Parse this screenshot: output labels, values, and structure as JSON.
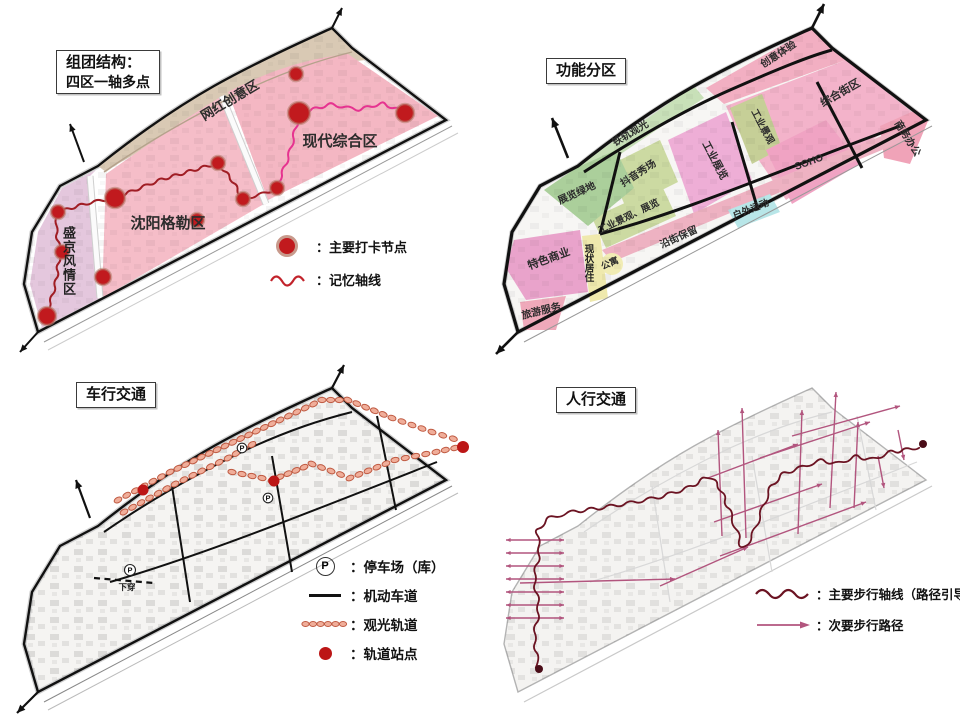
{
  "colors": {
    "zone_pink": "#f5bdc8",
    "zone_purple": "#e4c7dd",
    "band_beige": "#d9c9b4",
    "node_red": "#c11a1e",
    "memory_axis_west": "#a01d24",
    "memory_axis_east": "#e63390",
    "zone_green": "#abcf9b",
    "zone_yellow_green": "#ccdaa2",
    "zone_cyan": "#b8e6e8",
    "zone_pale_yellow": "#efe9ad",
    "track_orange": "#f0ae9a",
    "station_red": "#bc1616",
    "road_black": "#111111",
    "main_walk_axis": "#6b1322",
    "secondary_walk_path": "#b2557e"
  },
  "panels": {
    "group_structure": {
      "title_line1": "组团结构：",
      "title_line2": "四区一轴多点",
      "zones": {
        "wanghong": "网红创意区",
        "xiandai": "现代综合区",
        "shenyang": "沈阳格勒区",
        "shengjing": "盛京风情区"
      },
      "legend": [
        {
          "symbol": "node-dot",
          "label": "：主要打卡节点"
        },
        {
          "symbol": "wavy-line",
          "label": "：记忆轴线"
        }
      ]
    },
    "functional_zoning": {
      "title": "功能分区",
      "zones": {
        "tiegui": "铁轨观光",
        "chuangyi": "创意体验",
        "zonghe": "综合街区",
        "shangwu": "商务办公",
        "soho": "SOHO",
        "gongye_zhanlan": "工业展览",
        "gongye_jingguan": "工业景观",
        "douyin": "抖音秀场",
        "gongye_jingguan_zhanlan": "工业景观、展览",
        "zhanlan_lvdi": "展览绿地",
        "tese_shangye": "特色商业",
        "xianzhuang_juzhu": "现状居住",
        "gongyu": "公寓",
        "yanjie_baoliu": "沿街保留",
        "huwai_yundong": "户外运动",
        "lvyou_fuwu": "旅游服务"
      }
    },
    "vehicular_traffic": {
      "title": "车行交通",
      "parking_symbol": "P",
      "underpass_label": "下穿",
      "legend": [
        {
          "symbol": "parking-p",
          "label": "：停车场（库）"
        },
        {
          "symbol": "black-line",
          "label": "：机动车道"
        },
        {
          "symbol": "track-chain",
          "label": "：观光轨道"
        },
        {
          "symbol": "red-dot",
          "label": "：轨道站点"
        }
      ]
    },
    "pedestrian_traffic": {
      "title": "人行交通",
      "legend": [
        {
          "symbol": "dark-wavy",
          "label": "：主要步行轴线（路径引导）"
        },
        {
          "symbol": "pink-arrow",
          "label": "：次要步行路径"
        }
      ]
    }
  }
}
